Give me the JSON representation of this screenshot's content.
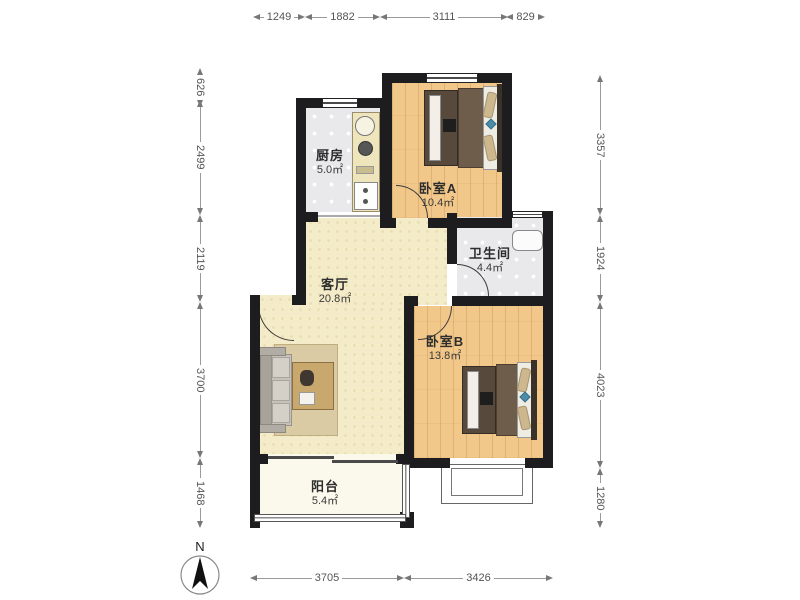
{
  "plan": {
    "rooms": {
      "kitchen": {
        "name": "厨房",
        "area": "5.0㎡"
      },
      "bedroom_a": {
        "name": "卧室A",
        "area": "10.4㎡"
      },
      "bathroom": {
        "name": "卫生间",
        "area": "4.4㎡"
      },
      "living_room": {
        "name": "客厅",
        "area": "20.8㎡"
      },
      "bedroom_b": {
        "name": "卧室B",
        "area": "13.8㎡"
      },
      "balcony": {
        "name": "阳台",
        "area": "5.4㎡"
      }
    },
    "compass": {
      "label": "N"
    },
    "dimensions_mm": {
      "top": [
        "1249",
        "1882",
        "3111",
        "829"
      ],
      "left": [
        "626",
        "2499",
        "2119",
        "3700",
        "1468"
      ],
      "right": [
        "3357",
        "1924",
        "4023",
        "1280"
      ],
      "bottom": [
        "3705",
        "3426"
      ]
    },
    "colors": {
      "wall": "#1d1d1f",
      "wood_floor": "#f2c88a",
      "tile_floor": "#e9e9ec",
      "living_floor": "#f4ebc8",
      "balcony_floor": "#fbf8ec",
      "dimension_text": "#555555"
    }
  }
}
